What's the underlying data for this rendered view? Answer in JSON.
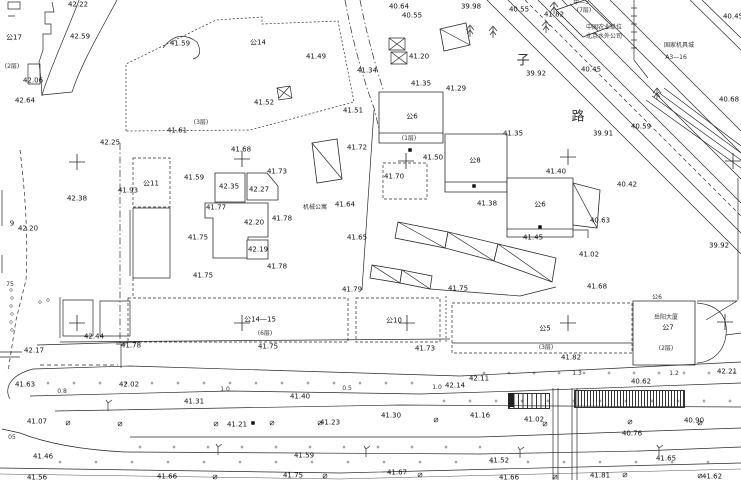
{
  "map": {
    "background": "#ffffff",
    "ink": "#2b2b2b"
  },
  "labels": [
    {
      "t": "42.22",
      "x": 78,
      "y": 5
    },
    {
      "t": "42.59",
      "x": 80,
      "y": 37
    },
    {
      "t": "42.06",
      "x": 33,
      "y": 81
    },
    {
      "t": "42.64",
      "x": 25,
      "y": 101
    },
    {
      "t": "公17",
      "x": 14,
      "y": 38,
      "k": "b"
    },
    {
      "t": "(2层)",
      "x": 12,
      "y": 67,
      "k": "n"
    },
    {
      "t": "41.59",
      "x": 180,
      "y": 44
    },
    {
      "t": "公14",
      "x": 258,
      "y": 43,
      "k": "b"
    },
    {
      "t": "41.49",
      "x": 316,
      "y": 57
    },
    {
      "t": "41.20",
      "x": 419,
      "y": 57
    },
    {
      "t": "40.64",
      "x": 399,
      "y": 7
    },
    {
      "t": "40.55",
      "x": 412,
      "y": 16
    },
    {
      "t": "39.98",
      "x": 471,
      "y": 7
    },
    {
      "t": "40.55",
      "x": 519,
      "y": 10
    },
    {
      "t": "41.82",
      "x": 554,
      "y": 15
    },
    {
      "t": "甲—5",
      "x": 581,
      "y": 3,
      "k": "n"
    },
    {
      "t": "(7层)",
      "x": 584,
      "y": 11,
      "k": "n"
    },
    {
      "t": "中国农业单位",
      "x": 604,
      "y": 28,
      "k": "n"
    },
    {
      "t": "北京水外公司",
      "x": 604,
      "y": 37,
      "k": "n"
    },
    {
      "t": "国家机具城",
      "x": 679,
      "y": 46,
      "k": "n"
    },
    {
      "t": "A3—16",
      "x": 676,
      "y": 58,
      "k": "n"
    },
    {
      "t": "40.45",
      "x": 733,
      "y": 17
    },
    {
      "t": "41.34",
      "x": 367,
      "y": 71
    },
    {
      "t": "41.35",
      "x": 421,
      "y": 84
    },
    {
      "t": "41.29",
      "x": 456,
      "y": 89
    },
    {
      "t": "39.92",
      "x": 536,
      "y": 74
    },
    {
      "t": "40.45",
      "x": 591,
      "y": 70
    },
    {
      "t": "子",
      "x": 523,
      "y": 61,
      "k": "s"
    },
    {
      "t": "路",
      "x": 578,
      "y": 117,
      "k": "s"
    },
    {
      "t": "40.68",
      "x": 729,
      "y": 100
    },
    {
      "t": "40.59",
      "x": 641,
      "y": 127
    },
    {
      "t": "39.91",
      "x": 603,
      "y": 134
    },
    {
      "t": "41.35",
      "x": 513,
      "y": 134
    },
    {
      "t": "42.25",
      "x": 110,
      "y": 143
    },
    {
      "t": "41.61",
      "x": 177,
      "y": 131
    },
    {
      "t": "(3层)",
      "x": 201,
      "y": 123,
      "k": "n"
    },
    {
      "t": "41.52",
      "x": 264,
      "y": 103
    },
    {
      "t": "41.51",
      "x": 353,
      "y": 111
    },
    {
      "t": "41.72",
      "x": 357,
      "y": 148
    },
    {
      "t": "41.68",
      "x": 241,
      "y": 150
    },
    {
      "t": "42.38",
      "x": 77,
      "y": 199
    },
    {
      "t": "41.59",
      "x": 194,
      "y": 178
    },
    {
      "t": "公11",
      "x": 151,
      "y": 184,
      "k": "b"
    },
    {
      "t": "41.93",
      "x": 128,
      "y": 191
    },
    {
      "t": "42.35",
      "x": 229,
      "y": 187
    },
    {
      "t": "42.27",
      "x": 259,
      "y": 190
    },
    {
      "t": "41.77",
      "x": 216,
      "y": 208
    },
    {
      "t": "42.20",
      "x": 254,
      "y": 223
    },
    {
      "t": "41.78",
      "x": 282,
      "y": 219
    },
    {
      "t": "41.73",
      "x": 277,
      "y": 172
    },
    {
      "t": "41.75",
      "x": 198,
      "y": 238
    },
    {
      "t": "42.19",
      "x": 258,
      "y": 250
    },
    {
      "t": "41.78",
      "x": 277,
      "y": 267
    },
    {
      "t": "41.75",
      "x": 203,
      "y": 276
    },
    {
      "t": "9",
      "x": 12,
      "y": 224
    },
    {
      "t": "42.20",
      "x": 28,
      "y": 229
    },
    {
      "t": "机械公寓",
      "x": 315,
      "y": 208,
      "k": "n"
    },
    {
      "t": "41.64",
      "x": 345,
      "y": 205
    },
    {
      "t": "41.65",
      "x": 357,
      "y": 238
    },
    {
      "t": "公6",
      "x": 412,
      "y": 117,
      "k": "b"
    },
    {
      "t": "(1层)",
      "x": 409,
      "y": 139,
      "k": "n"
    },
    {
      "t": "41.50",
      "x": 433,
      "y": 158
    },
    {
      "t": "41.70",
      "x": 394,
      "y": 177
    },
    {
      "t": "公8",
      "x": 475,
      "y": 161,
      "k": "b"
    },
    {
      "t": "41.38",
      "x": 487,
      "y": 204
    },
    {
      "t": "公6",
      "x": 540,
      "y": 205,
      "k": "b"
    },
    {
      "t": "41.40",
      "x": 556,
      "y": 172
    },
    {
      "t": "40.63",
      "x": 600,
      "y": 221
    },
    {
      "t": "41.45",
      "x": 533,
      "y": 238
    },
    {
      "t": "41.02",
      "x": 589,
      "y": 255
    },
    {
      "t": "41.68",
      "x": 597,
      "y": 287
    },
    {
      "t": "40.42",
      "x": 627,
      "y": 185
    },
    {
      "t": "39.92",
      "x": 719,
      "y": 246
    },
    {
      "t": "41.79",
      "x": 352,
      "y": 290
    },
    {
      "t": "41.75",
      "x": 458,
      "y": 289
    },
    {
      "t": "75",
      "x": 10,
      "y": 285,
      "k": "n"
    },
    {
      "t": "公14—15",
      "x": 260,
      "y": 320,
      "k": "b"
    },
    {
      "t": "(6层)",
      "x": 265,
      "y": 334,
      "k": "n"
    },
    {
      "t": "41.75",
      "x": 268,
      "y": 347
    },
    {
      "t": "公10",
      "x": 394,
      "y": 321,
      "k": "b"
    },
    {
      "t": "41.73",
      "x": 425,
      "y": 349
    },
    {
      "t": "公5",
      "x": 545,
      "y": 329,
      "k": "b"
    },
    {
      "t": "(3层)",
      "x": 546,
      "y": 348,
      "k": "n"
    },
    {
      "t": "41.82",
      "x": 571,
      "y": 358
    },
    {
      "t": "公6",
      "x": 657,
      "y": 298,
      "k": "n"
    },
    {
      "t": "岳阳大厦",
      "x": 666,
      "y": 318,
      "k": "n"
    },
    {
      "t": "公7",
      "x": 668,
      "y": 328,
      "k": "b"
    },
    {
      "t": "(2层)",
      "x": 666,
      "y": 349,
      "k": "n"
    },
    {
      "t": "42.21",
      "x": 727,
      "y": 372
    },
    {
      "t": "42.17",
      "x": 34,
      "y": 351
    },
    {
      "t": "42.44",
      "x": 94,
      "y": 337
    },
    {
      "t": "41.78",
      "x": 131,
      "y": 346
    },
    {
      "t": "41.63",
      "x": 25,
      "y": 385
    },
    {
      "t": "42.02",
      "x": 129,
      "y": 385
    },
    {
      "t": "0.8",
      "x": 62,
      "y": 392,
      "k": "n"
    },
    {
      "t": "1.0",
      "x": 225,
      "y": 390,
      "k": "n"
    },
    {
      "t": "41.31",
      "x": 194,
      "y": 402
    },
    {
      "t": "0.5",
      "x": 347,
      "y": 389,
      "k": "n"
    },
    {
      "t": "41.40",
      "x": 300,
      "y": 397
    },
    {
      "t": "42.14",
      "x": 455,
      "y": 386
    },
    {
      "t": "1.0",
      "x": 437,
      "y": 388,
      "k": "n"
    },
    {
      "t": "42.11",
      "x": 479,
      "y": 379
    },
    {
      "t": "1.3",
      "x": 577,
      "y": 374,
      "k": "n"
    },
    {
      "t": "1.2",
      "x": 674,
      "y": 374,
      "k": "n"
    },
    {
      "t": "40.62",
      "x": 641,
      "y": 382
    },
    {
      "t": "41.30",
      "x": 391,
      "y": 416
    },
    {
      "t": "41.16",
      "x": 480,
      "y": 416
    },
    {
      "t": "41.07",
      "x": 37,
      "y": 422
    },
    {
      "t": "41.21",
      "x": 237,
      "y": 425
    },
    {
      "t": "41.23",
      "x": 330,
      "y": 423
    },
    {
      "t": "05",
      "x": 12,
      "y": 438,
      "k": "n"
    },
    {
      "t": "41.46",
      "x": 43,
      "y": 457
    },
    {
      "t": "41.56",
      "x": 37,
      "y": 478
    },
    {
      "t": "41.66",
      "x": 167,
      "y": 477
    },
    {
      "t": "41.59",
      "x": 304,
      "y": 456
    },
    {
      "t": "41.75",
      "x": 293,
      "y": 476
    },
    {
      "t": "41.67",
      "x": 397,
      "y": 473
    },
    {
      "t": "41.02",
      "x": 534,
      "y": 420
    },
    {
      "t": "40.90",
      "x": 694,
      "y": 421
    },
    {
      "t": "40.76",
      "x": 632,
      "y": 434
    },
    {
      "t": "41.52",
      "x": 499,
      "y": 461
    },
    {
      "t": "41.65",
      "x": 666,
      "y": 459
    },
    {
      "t": "41.66",
      "x": 509,
      "y": 478
    },
    {
      "t": "41.81",
      "x": 600,
      "y": 476
    },
    {
      "t": "41.62",
      "x": 712,
      "y": 477
    }
  ],
  "symbols": {
    "crosses": [
      [
        77,
        162
      ],
      [
        242,
        159
      ],
      [
        406,
        161
      ],
      [
        568,
        157
      ],
      [
        733,
        161
      ],
      [
        77,
        323
      ],
      [
        242,
        323
      ],
      [
        407,
        323
      ],
      [
        568,
        323
      ],
      [
        725,
        322
      ]
    ],
    "trees": [
      [
        470,
        31
      ],
      [
        493,
        32
      ],
      [
        546,
        27
      ],
      [
        554,
        8
      ],
      [
        657,
        94
      ]
    ],
    "lamps": [
      [
        108,
        403
      ],
      [
        218,
        447
      ],
      [
        366,
        449
      ],
      [
        520,
        450
      ],
      [
        659,
        448
      ]
    ],
    "circles": [
      [
        68,
        423
      ],
      [
        120,
        424
      ],
      [
        216,
        424
      ],
      [
        272,
        423
      ],
      [
        320,
        423
      ],
      [
        436,
        420
      ],
      [
        545,
        424
      ],
      [
        630,
        422
      ],
      [
        700,
        423
      ],
      [
        215,
        477
      ],
      [
        325,
        476
      ],
      [
        420,
        475
      ],
      [
        555,
        477
      ],
      [
        625,
        475
      ],
      [
        700,
        476
      ]
    ],
    "black_squares": [
      [
        410,
        150
      ],
      [
        474,
        186
      ],
      [
        540,
        227
      ],
      [
        253,
        423
      ]
    ],
    "fence_dots": [
      [
        11,
        290
      ],
      [
        12,
        298
      ],
      [
        11,
        306
      ],
      [
        12,
        314
      ],
      [
        11,
        322
      ],
      [
        12,
        330
      ],
      [
        40,
        302
      ],
      [
        48,
        300
      ]
    ]
  },
  "dot_rows": [
    {
      "y": 383,
      "x0": 48,
      "x1": 430,
      "step": 26
    },
    {
      "y": 373,
      "x0": 484,
      "x1": 740,
      "step": 25
    },
    {
      "y": 401,
      "x0": 444,
      "x1": 740,
      "step": 26
    },
    {
      "y": 447,
      "x0": 140,
      "x1": 480,
      "step": 34
    },
    {
      "y": 462,
      "x0": 60,
      "x1": 740,
      "step": 36
    }
  ]
}
